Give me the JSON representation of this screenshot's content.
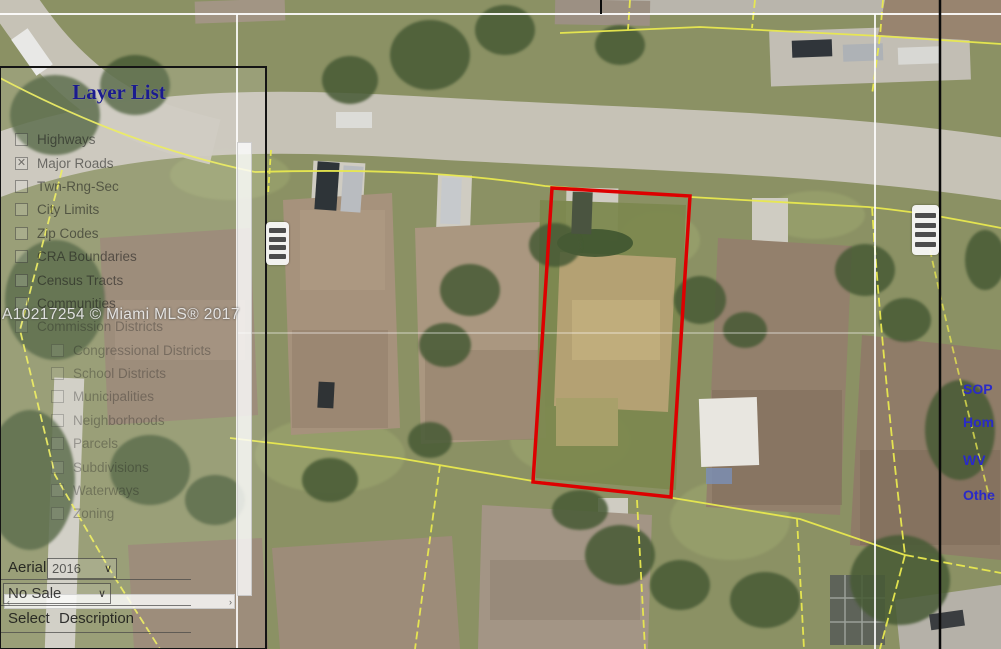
{
  "window": {
    "width": 1001,
    "height": 649
  },
  "watermark_text": "A10217254 © Miami MLS® 2017",
  "panel": {
    "title": "Layer List",
    "items": [
      {
        "label": "Highways",
        "checked": false
      },
      {
        "label": "Major Roads",
        "checked": true
      },
      {
        "label": "Twn-Rng-Sec",
        "checked": false
      },
      {
        "label": "City Limits",
        "checked": false
      },
      {
        "label": "Zip Codes",
        "checked": false
      },
      {
        "label": "CRA Boundaries",
        "checked": false
      },
      {
        "label": "Census Tracts",
        "checked": false
      },
      {
        "label": "Communities",
        "checked": false
      },
      {
        "label": "Commission Districts",
        "checked": false
      },
      {
        "label": "Congressional Districts",
        "checked": false
      },
      {
        "label": "School Districts",
        "checked": false
      },
      {
        "label": "Municipalities",
        "checked": false
      },
      {
        "label": "Neighborhoods",
        "checked": false
      },
      {
        "label": "Parcels",
        "checked": false
      },
      {
        "label": "Subdivisions",
        "checked": false
      },
      {
        "label": "Waterways",
        "checked": false
      },
      {
        "label": "Zoning",
        "checked": false
      }
    ]
  },
  "controls": {
    "aerial_label": "Aerial",
    "aerial_value": "2016",
    "no_sale_value": "No Sale",
    "select_label": "Select",
    "description_label": "Description"
  },
  "right_links": [
    {
      "text": "SOP"
    },
    {
      "text": "Hom"
    },
    {
      "text": "WV"
    },
    {
      "text": "Othe"
    }
  ],
  "icons": {
    "check_glyph": "✕",
    "caret_glyph": "∨",
    "hscroll_left_glyph": "‹",
    "hscroll_right_glyph": "›"
  },
  "colors": {
    "parcel_highlight": "#dd0000",
    "parcel_line": "#e9e94f",
    "panel_title": "#1b1b8e",
    "link_blue": "#2a2ac8"
  }
}
